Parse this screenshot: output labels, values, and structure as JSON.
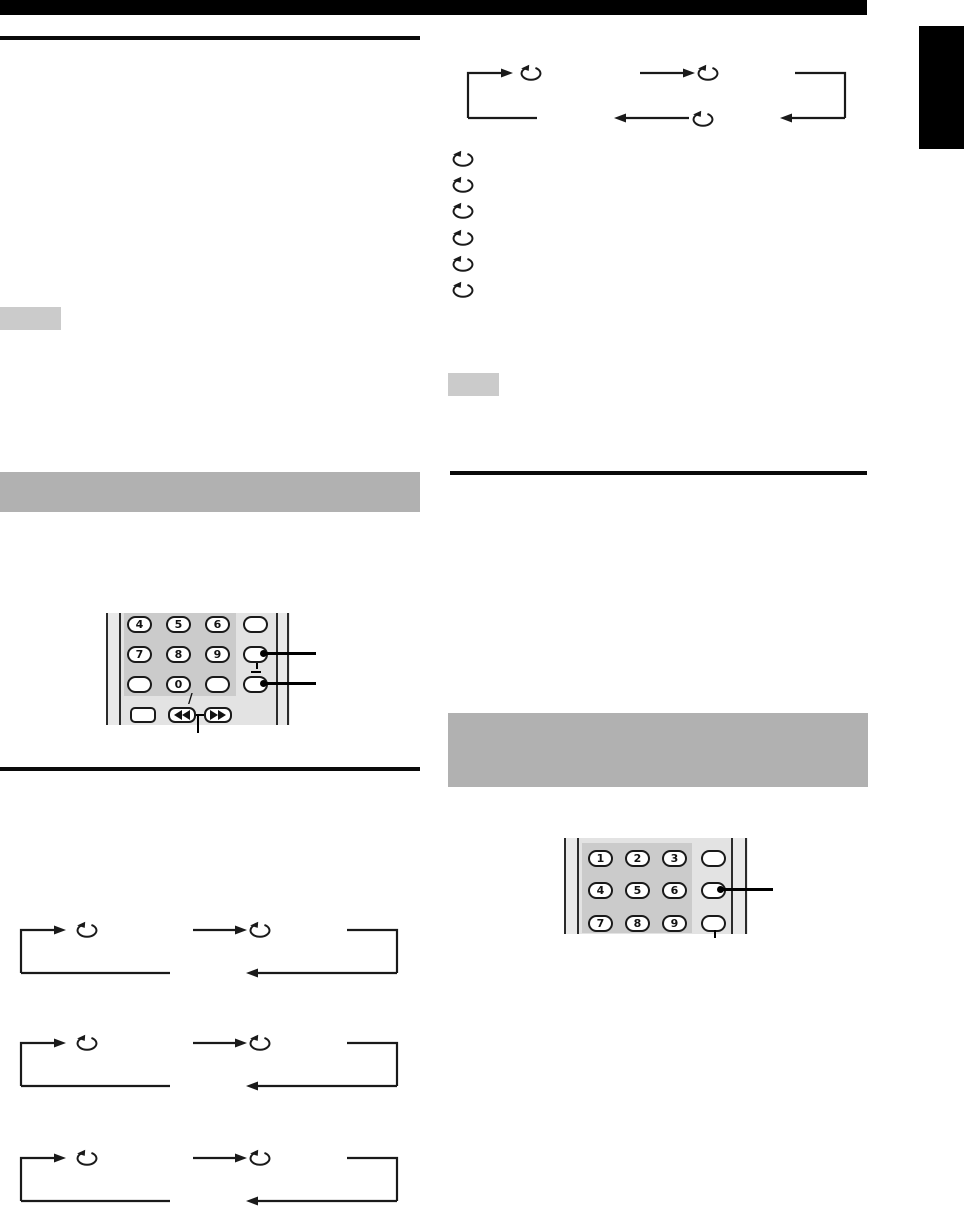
{
  "document": {
    "kind": "scanned-manual-page"
  },
  "top_bar": {
    "color": "#000000"
  },
  "side_tab": {
    "color": "#000000"
  },
  "colors": {
    "rule": "#0a0a0a",
    "note_box": "#cbcbcb",
    "section_bar": "#b1b1b1",
    "diagram_line": "#1a1a1a",
    "remote_body": "#e3e3e3",
    "remote_edge": "#2b2b2b",
    "keypad_panel": "#cbcbcb",
    "button_fill": "#ffffff",
    "button_border": "#1a1a1a",
    "callout": "#000000"
  },
  "icons": {
    "loop": "loop-arrow-icon",
    "rewind": "rewind-icon",
    "fast_forward": "fast-forward-icon"
  },
  "left_remote": {
    "rows": [
      [
        "4",
        "5",
        "6"
      ],
      [
        "7",
        "8",
        "9"
      ],
      [
        "",
        "0",
        ""
      ]
    ],
    "slash": "/"
  },
  "right_remote": {
    "rows": [
      [
        "1",
        "2",
        "3"
      ],
      [
        "4",
        "5",
        "6"
      ],
      [
        "7",
        "8",
        "9"
      ]
    ]
  },
  "right_column": {
    "loop_list_count": 6
  }
}
